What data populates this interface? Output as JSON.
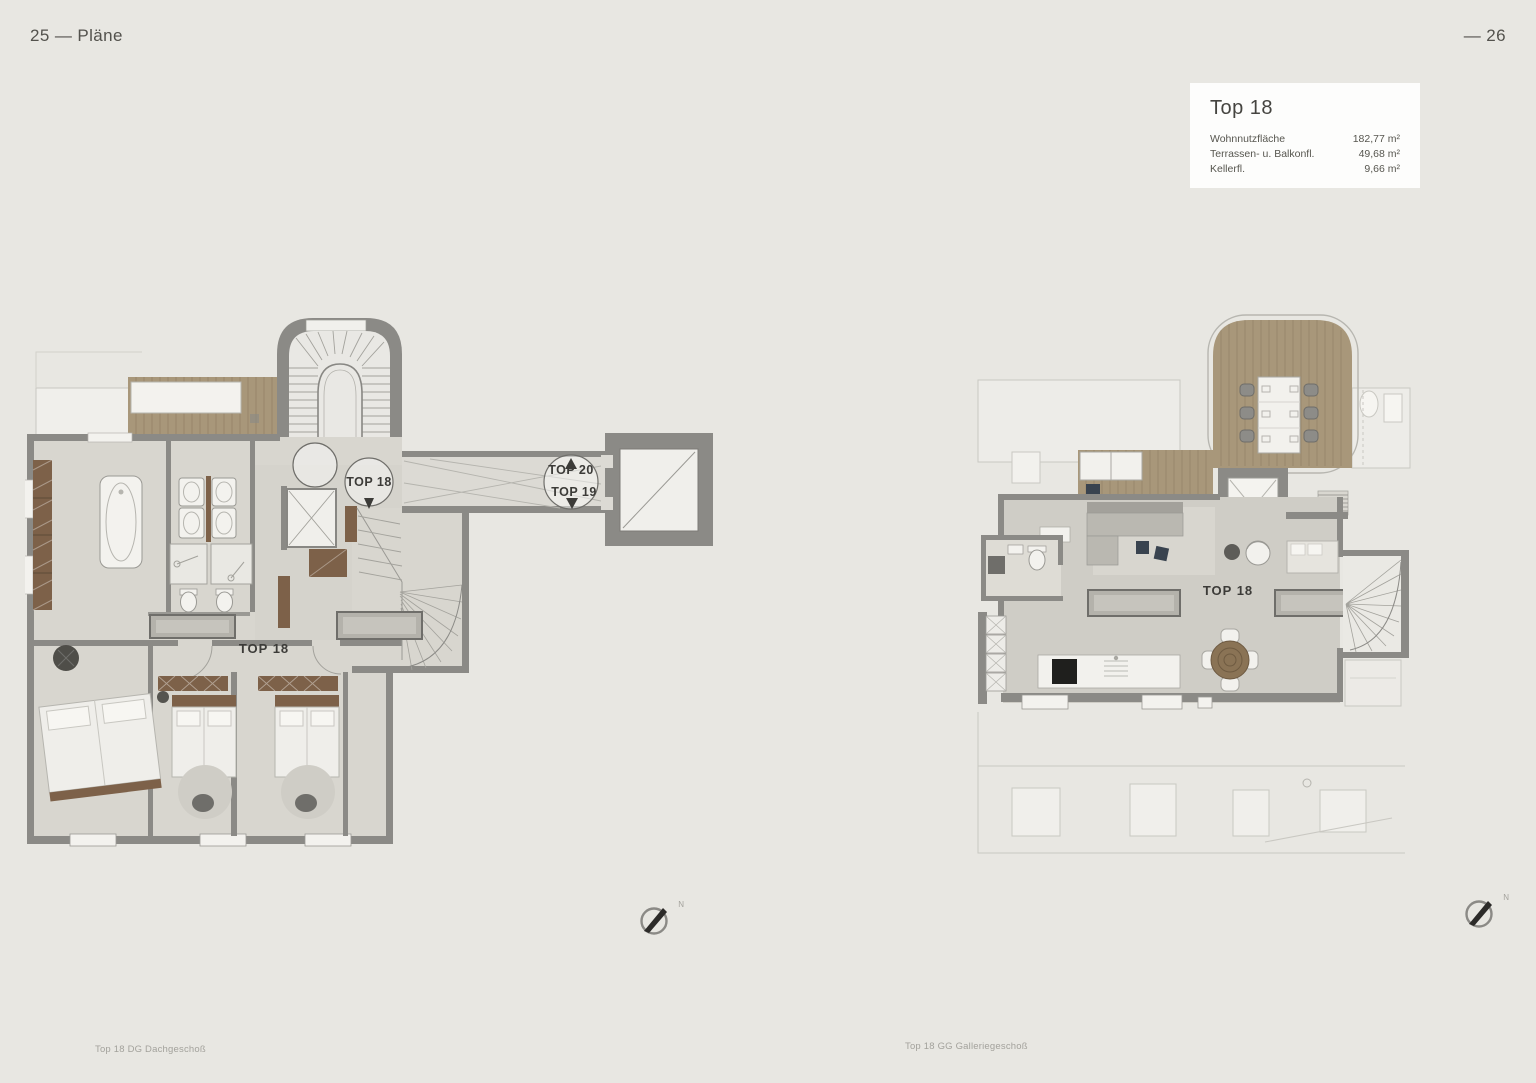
{
  "page": {
    "header_left": "25 — Pläne",
    "header_right": "— 26"
  },
  "info_box": {
    "title": "Top 18",
    "rows": [
      {
        "label": "Wohnnutzfläche",
        "value": "182,77 m²"
      },
      {
        "label": "Terrassen- u. Balkonfl.",
        "value": "49,68 m²"
      },
      {
        "label": "Kellerfl.",
        "value": "9,66 m²"
      }
    ]
  },
  "plans": {
    "left": {
      "caption": "Top 18 DG Dachgeschoß",
      "room_label": "TOP 18",
      "circle_label": "TOP 18",
      "stair_label_up": "TOP 20",
      "stair_label_down": "TOP 19",
      "compass_n": "N"
    },
    "right": {
      "caption": "Top 18 GG Galleriegeschoß",
      "room_label": "TOP 18",
      "compass_n": "N"
    }
  },
  "colors": {
    "background": "#e8e7e2",
    "wall": "#8b8a86",
    "floor": "#d8d6cf",
    "wood_deck": "#a8977a",
    "furniture_brown": "#7d6149",
    "accent_navy": "#39434f",
    "info_box_bg": "#fdfdfc"
  }
}
